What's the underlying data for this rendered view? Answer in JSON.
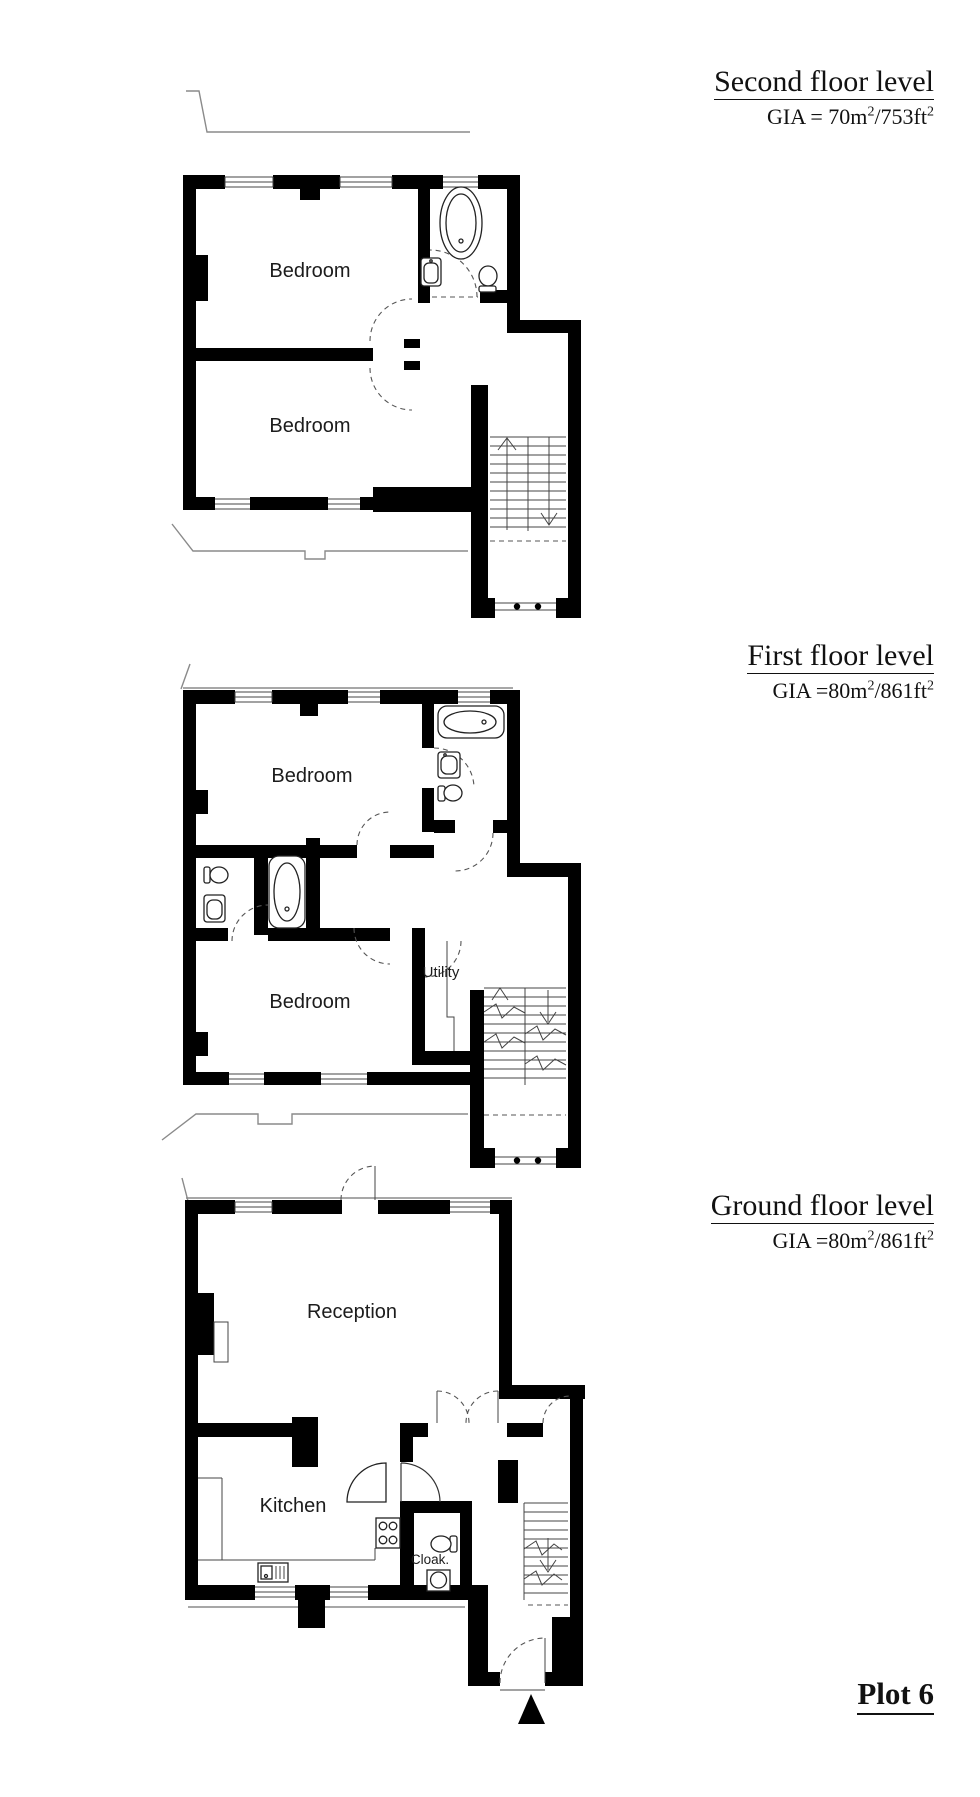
{
  "document": {
    "type": "property floorplan sheet",
    "plot_label": "Plot 6",
    "colors": {
      "walls": "#000000",
      "lines": "#555555",
      "text": "#1c1c1c",
      "background": "#ffffff"
    }
  },
  "floors": [
    {
      "id": "second",
      "title": "Second floor level",
      "gia": {
        "p1": "GIA = 70m",
        "s1": "2",
        "p2": "/753ft",
        "s2": "2"
      },
      "rooms": [
        {
          "label": "Bedroom"
        },
        {
          "label": "Bedroom"
        }
      ]
    },
    {
      "id": "first",
      "title": "First floor level",
      "gia": {
        "p1": "GIA =80m",
        "s1": "2",
        "p2": "/861ft",
        "s2": "2"
      },
      "rooms": [
        {
          "label": "Bedroom"
        },
        {
          "label": "Bedroom"
        },
        {
          "label": "Utility"
        }
      ]
    },
    {
      "id": "ground",
      "title": "Ground floor level",
      "gia": {
        "p1": "GIA =80m",
        "s1": "2",
        "p2": "/861ft",
        "s2": "2"
      },
      "rooms": [
        {
          "label": "Reception"
        },
        {
          "label": "Kitchen"
        },
        {
          "label": "Cloak."
        }
      ]
    }
  ]
}
